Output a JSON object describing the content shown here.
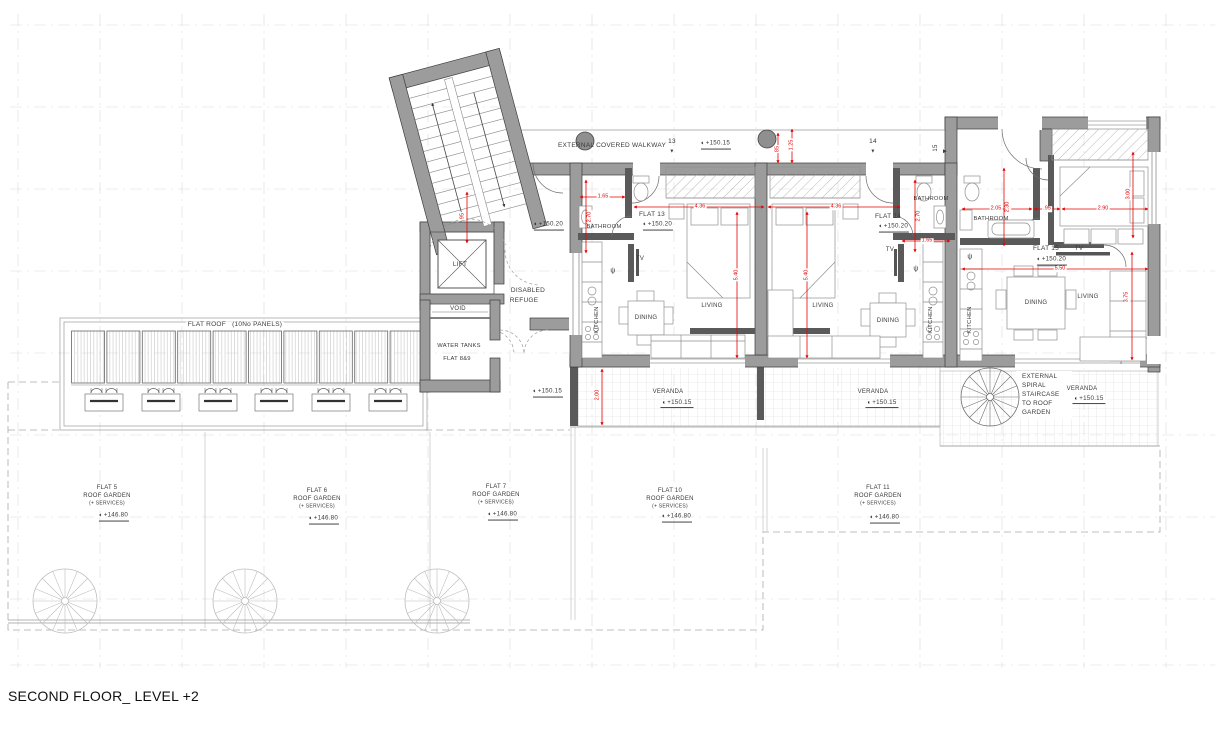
{
  "drawing_title": "SECOND FLOOR_ LEVEL +2",
  "colors": {
    "dimension_red": "#e60000",
    "wall_gray": "#9c9c9c",
    "text_dark": "#3a3a3a",
    "grid_gray": "#dcdcdc"
  },
  "plan": {
    "grid": {
      "xs": [
        18,
        100,
        182,
        264,
        346,
        428,
        510,
        592,
        674,
        756,
        838,
        920,
        1002,
        1084,
        1166
      ],
      "ys": [
        25,
        107,
        189,
        271,
        353,
        435,
        517,
        599,
        665
      ]
    },
    "flat_roof": {
      "panels": 10,
      "x0": 71.5,
      "y": 331,
      "w": 33,
      "gap": 2.4,
      "h": 52,
      "unit_xs": [
        104,
        161,
        218,
        274,
        331,
        388
      ]
    },
    "spiral_stairs": [
      {
        "id": "spiral-stair-garden-1",
        "x": 65,
        "y": 601,
        "r": 32,
        "c": "#bdbdbd"
      },
      {
        "id": "spiral-stair-garden-2",
        "x": 245,
        "y": 601,
        "r": 32,
        "c": "#bdbdbd"
      },
      {
        "id": "spiral-stair-garden-3",
        "x": 437,
        "y": 601,
        "r": 32,
        "c": "#bdbdbd"
      },
      {
        "id": "spiral-stair-veranda",
        "x": 990,
        "y": 397,
        "r": 29,
        "c": "#6f6f6f"
      }
    ],
    "labels": [
      {
        "id": "external-covered-walkway-label",
        "text": "EXTERNAL COVERED WALKWAY",
        "x": 612,
        "y": 146,
        "fs": 6.5
      },
      {
        "id": "walkway-marker-13",
        "text": "13",
        "x": 672,
        "y": 142,
        "fs": 6.5
      },
      {
        "id": "walkway-marker-13-icon",
        "text": "▼",
        "x": 672,
        "y": 152,
        "fs": 5
      },
      {
        "id": "walkway-level",
        "text": "+150.15",
        "x": 716,
        "y": 145,
        "fs": 6.2,
        "level": true
      },
      {
        "id": "walkway-marker-14",
        "text": "14",
        "x": 873,
        "y": 142,
        "fs": 6.5
      },
      {
        "id": "walkway-marker-14-icon",
        "text": "▼",
        "x": 873,
        "y": 152,
        "fs": 5
      },
      {
        "id": "walkway-marker-15",
        "text": "15",
        "x": 936,
        "y": 148,
        "fs": 6,
        "rot": -90
      },
      {
        "id": "walkway-marker-15-icon",
        "text": "▶",
        "x": 945,
        "y": 152,
        "fs": 5
      },
      {
        "id": "flat13-name",
        "text": "FLAT 13",
        "x": 652,
        "y": 215,
        "fs": 6.5
      },
      {
        "id": "flat13-level",
        "text": "+150.20",
        "x": 658,
        "y": 226,
        "fs": 6.2,
        "level": true
      },
      {
        "id": "flat14-name",
        "text": "FLAT 14",
        "x": 888,
        "y": 217,
        "fs": 6.5
      },
      {
        "id": "flat14-level",
        "text": "+150.20",
        "x": 894,
        "y": 228,
        "fs": 6.2,
        "level": true
      },
      {
        "id": "flat15-name",
        "text": "FLAT 15",
        "x": 1046,
        "y": 249,
        "fs": 6.5
      },
      {
        "id": "flat15-level",
        "text": "+150.20",
        "x": 1052,
        "y": 261,
        "fs": 6.2,
        "level": true
      },
      {
        "id": "flat13-bathroom-label",
        "text": "BATHROOM",
        "x": 604,
        "y": 228,
        "fs": 5.8
      },
      {
        "id": "flat14-bathroom-label",
        "text": "BATHROOM",
        "x": 931,
        "y": 200,
        "fs": 5.8
      },
      {
        "id": "flat15-bathroom-label",
        "text": "BATHROOM",
        "x": 991,
        "y": 220,
        "fs": 5.8
      },
      {
        "id": "flat13-tv-label",
        "text": "TV",
        "x": 640,
        "y": 259,
        "fs": 6
      },
      {
        "id": "flat14-tv-label",
        "text": "TV",
        "x": 890,
        "y": 250,
        "fs": 6
      },
      {
        "id": "flat15-tv-label",
        "text": "TV",
        "x": 1079,
        "y": 249,
        "fs": 6
      },
      {
        "id": "flat13-kitchen-label",
        "text": "KITCHEN",
        "x": 598,
        "y": 320,
        "fs": 5.8,
        "rot": -90
      },
      {
        "id": "flat14-kitchen-label",
        "text": "KITCHEN",
        "x": 932,
        "y": 320,
        "fs": 5.8,
        "rot": -90
      },
      {
        "id": "flat15-kitchen-label",
        "text": "KITCHEN",
        "x": 971,
        "y": 320,
        "fs": 5.8,
        "rot": -90
      },
      {
        "id": "flat13-dining-label",
        "text": "DINING",
        "x": 646,
        "y": 318,
        "fs": 6,
        "bg": true
      },
      {
        "id": "flat14-dining-label",
        "text": "DINING",
        "x": 888,
        "y": 321,
        "fs": 6,
        "bg": true
      },
      {
        "id": "flat15-dining-label",
        "text": "DINING",
        "x": 1036,
        "y": 303,
        "fs": 6,
        "bg": true
      },
      {
        "id": "flat13-living-label",
        "text": "LIVING",
        "x": 712,
        "y": 306,
        "fs": 6
      },
      {
        "id": "flat14-living-label",
        "text": "LIVING",
        "x": 823,
        "y": 306,
        "fs": 6
      },
      {
        "id": "flat15-living-label",
        "text": "LIVING",
        "x": 1088,
        "y": 297,
        "fs": 6
      },
      {
        "id": "flat13-psi-symbol",
        "text": "ψ",
        "x": 613,
        "y": 271,
        "fs": 7
      },
      {
        "id": "flat14-psi-symbol",
        "text": "ψ",
        "x": 916,
        "y": 269,
        "fs": 7
      },
      {
        "id": "flat15-psi-symbol",
        "text": "ψ",
        "x": 970,
        "y": 257,
        "fs": 7
      },
      {
        "id": "lift-label",
        "text": "LIFT",
        "x": 460,
        "y": 265,
        "fs": 6.5
      },
      {
        "id": "disabled-refuge-label-1",
        "text": "DISABLED",
        "x": 528,
        "y": 291,
        "fs": 6.5
      },
      {
        "id": "disabled-refuge-label-2",
        "text": "REFUGE",
        "x": 524,
        "y": 301,
        "fs": 6.5
      },
      {
        "id": "void-label",
        "text": "VOID",
        "x": 458,
        "y": 309,
        "fs": 6
      },
      {
        "id": "water-tanks-label-1",
        "text": "WATER TANKS",
        "x": 459,
        "y": 347,
        "fs": 5.8
      },
      {
        "id": "water-tanks-label-2",
        "text": "FLAT 8&9",
        "x": 457,
        "y": 360,
        "fs": 5.8
      },
      {
        "id": "corridor-level",
        "text": "+150.20",
        "x": 549,
        "y": 226,
        "fs": 6.2,
        "level": true
      },
      {
        "id": "lobby-south-level",
        "text": "+150.15",
        "x": 548,
        "y": 393,
        "fs": 6.2,
        "level": true
      },
      {
        "id": "flat-roof-label",
        "text": "FLAT ROOF   (10No PANELS)",
        "x": 235,
        "y": 325,
        "fs": 6.5,
        "bg": true
      },
      {
        "id": "veranda1-label",
        "text": "VERANDA",
        "x": 668,
        "y": 392,
        "fs": 6,
        "bg": true
      },
      {
        "id": "veranda1-level",
        "text": "+150.15",
        "x": 677,
        "y": 404,
        "fs": 6.2,
        "level": true,
        "bg": true
      },
      {
        "id": "veranda2-label",
        "text": "VERANDA",
        "x": 873,
        "y": 392,
        "fs": 6,
        "bg": true
      },
      {
        "id": "veranda2-level",
        "text": "+150.15",
        "x": 882,
        "y": 404,
        "fs": 6.2,
        "level": true,
        "bg": true
      },
      {
        "id": "veranda3-label",
        "text": "VERANDA",
        "x": 1082,
        "y": 389,
        "fs": 6,
        "bg": true
      },
      {
        "id": "veranda3-level",
        "text": "+150.15",
        "x": 1089,
        "y": 400,
        "fs": 6.2,
        "level": true,
        "bg": true
      },
      {
        "id": "spiral-note-1",
        "text": "EXTERNAL",
        "x": 1020,
        "y": 377,
        "fs": 6.3,
        "align": "left",
        "bg": true
      },
      {
        "id": "spiral-note-2",
        "text": "SPIRAL",
        "x": 1020,
        "y": 386,
        "fs": 6.3,
        "align": "left",
        "bg": true
      },
      {
        "id": "spiral-note-3",
        "text": "STAIRCASE",
        "x": 1020,
        "y": 395,
        "fs": 6.3,
        "align": "left",
        "bg": true
      },
      {
        "id": "spiral-note-4",
        "text": "TO ROOF",
        "x": 1020,
        "y": 404,
        "fs": 6.3,
        "align": "left",
        "bg": true
      },
      {
        "id": "spiral-note-5",
        "text": "GARDEN",
        "x": 1020,
        "y": 413,
        "fs": 6.3,
        "align": "left",
        "bg": true
      },
      {
        "id": "flat5-garden-name",
        "text": "FLAT 5",
        "x": 107,
        "y": 488,
        "fs": 6
      },
      {
        "id": "flat5-garden-label",
        "text": "ROOF GARDEN",
        "x": 107,
        "y": 496,
        "fs": 6
      },
      {
        "id": "flat5-garden-services",
        "text": "(+ SERVICES)",
        "x": 107,
        "y": 504,
        "fs": 5
      },
      {
        "id": "flat5-garden-level",
        "text": "+146.80",
        "x": 114,
        "y": 517,
        "fs": 6.2,
        "level": true
      },
      {
        "id": "flat6-garden-name",
        "text": "FLAT 6",
        "x": 317,
        "y": 491,
        "fs": 6
      },
      {
        "id": "flat6-garden-label",
        "text": "ROOF GARDEN",
        "x": 317,
        "y": 499,
        "fs": 6
      },
      {
        "id": "flat6-garden-services",
        "text": "(+ SERVICES)",
        "x": 317,
        "y": 507,
        "fs": 5
      },
      {
        "id": "flat6-garden-level",
        "text": "+146.80",
        "x": 324,
        "y": 520,
        "fs": 6.2,
        "level": true
      },
      {
        "id": "flat7-garden-name",
        "text": "FLAT 7",
        "x": 496,
        "y": 487,
        "fs": 6
      },
      {
        "id": "flat7-garden-label",
        "text": "ROOF GARDEN",
        "x": 496,
        "y": 495,
        "fs": 6
      },
      {
        "id": "flat7-garden-services",
        "text": "(+ SERVICES)",
        "x": 496,
        "y": 503,
        "fs": 5
      },
      {
        "id": "flat7-garden-level",
        "text": "+146.80",
        "x": 503,
        "y": 516,
        "fs": 6.2,
        "level": true
      },
      {
        "id": "flat10-garden-name",
        "text": "FLAT 10",
        "x": 670,
        "y": 491,
        "fs": 6
      },
      {
        "id": "flat10-garden-label",
        "text": "ROOF GARDEN",
        "x": 670,
        "y": 499,
        "fs": 6
      },
      {
        "id": "flat10-garden-services",
        "text": "(+ SERVICES)",
        "x": 670,
        "y": 507,
        "fs": 5
      },
      {
        "id": "flat10-garden-level",
        "text": "+146.80",
        "x": 677,
        "y": 518,
        "fs": 6.2,
        "level": true
      },
      {
        "id": "flat11-garden-name",
        "text": "FLAT 11",
        "x": 878,
        "y": 488,
        "fs": 6
      },
      {
        "id": "flat11-garden-label",
        "text": "ROOF GARDEN",
        "x": 878,
        "y": 496,
        "fs": 6
      },
      {
        "id": "flat11-garden-services",
        "text": "(+ SERVICES)",
        "x": 878,
        "y": 504,
        "fs": 5
      },
      {
        "id": "flat11-garden-level",
        "text": "+146.80",
        "x": 885,
        "y": 519,
        "fs": 6.2,
        "level": true
      }
    ],
    "dimensions": [
      {
        "id": "dim-f13-bath-width",
        "text": "1.65",
        "x": 603,
        "y": 197,
        "line": [
          580,
          197,
          625,
          197
        ]
      },
      {
        "id": "dim-f13-bath-depth",
        "text": "2.70",
        "x": 590,
        "y": 217,
        "rot": -90,
        "line": [
          586,
          180,
          586,
          253
        ]
      },
      {
        "id": "dim-f13-bed-width",
        "text": "4.36",
        "x": 700,
        "y": 207,
        "line": [
          634,
          207,
          764,
          207
        ]
      },
      {
        "id": "dim-f13-depth",
        "text": "5.40",
        "x": 737,
        "y": 275,
        "rot": -90,
        "line": [
          737,
          212,
          737,
          358
        ]
      },
      {
        "id": "dim-f14-bed-width",
        "text": "4.36",
        "x": 836,
        "y": 207,
        "line": [
          768,
          207,
          900,
          207
        ]
      },
      {
        "id": "dim-f14-depth",
        "text": "5.40",
        "x": 807,
        "y": 275,
        "rot": -90,
        "line": [
          807,
          212,
          807,
          358
        ]
      },
      {
        "id": "dim-f14-bath-depth",
        "text": "2.70",
        "x": 919,
        "y": 216,
        "rot": -90,
        "line": [
          915,
          180,
          915,
          252
        ]
      },
      {
        "id": "dim-f14-bath-width",
        "text": "1.65",
        "x": 927,
        "y": 241,
        "line": [
          902,
          241,
          950,
          241
        ]
      },
      {
        "id": "dim-f15-bath-width",
        "text": "2.05",
        "x": 996,
        "y": 209,
        "line": [
          962,
          209,
          1032,
          209
        ]
      },
      {
        "id": "dim-f15-bath-depth",
        "text": "2.30",
        "x": 1008,
        "y": 207,
        "rot": -90,
        "line": [
          1004,
          168,
          1004,
          246
        ]
      },
      {
        "id": "dim-f15-hall",
        "text": ".95",
        "x": 1047,
        "y": 209,
        "line": [
          1034,
          209,
          1060,
          209
        ]
      },
      {
        "id": "dim-f15-bed-width",
        "text": "2.90",
        "x": 1103,
        "y": 209,
        "line": [
          1062,
          209,
          1148,
          209
        ]
      },
      {
        "id": "dim-f15-bed-depth",
        "text": "3.00",
        "x": 1129,
        "y": 194,
        "rot": -90,
        "line": [
          1133,
          152,
          1133,
          238
        ]
      },
      {
        "id": "dim-f15-living-width",
        "text": "5.50",
        "x": 1060,
        "y": 269,
        "line": [
          962,
          269,
          1148,
          269
        ]
      },
      {
        "id": "dim-f15-living-depth",
        "text": "3.75",
        "x": 1127,
        "y": 297,
        "rot": -90,
        "line": [
          1132,
          252,
          1132,
          360
        ]
      },
      {
        "id": "dim-walkway-a",
        "text": "85",
        "x": 778,
        "y": 149,
        "rot": -90,
        "line": [
          778,
          133,
          778,
          163
        ]
      },
      {
        "id": "dim-walkway-b",
        "text": "1.25",
        "x": 792,
        "y": 145,
        "rot": -90,
        "line": [
          792,
          129,
          792,
          163
        ]
      },
      {
        "id": "dim-stair",
        "text": "95",
        "x": 463,
        "y": 216,
        "rot": -90,
        "line": [
          467,
          192,
          467,
          243
        ]
      },
      {
        "id": "dim-veranda-depth",
        "text": "2.00",
        "x": 598,
        "y": 395,
        "rot": -90,
        "line": [
          602,
          369,
          602,
          425
        ]
      }
    ]
  }
}
